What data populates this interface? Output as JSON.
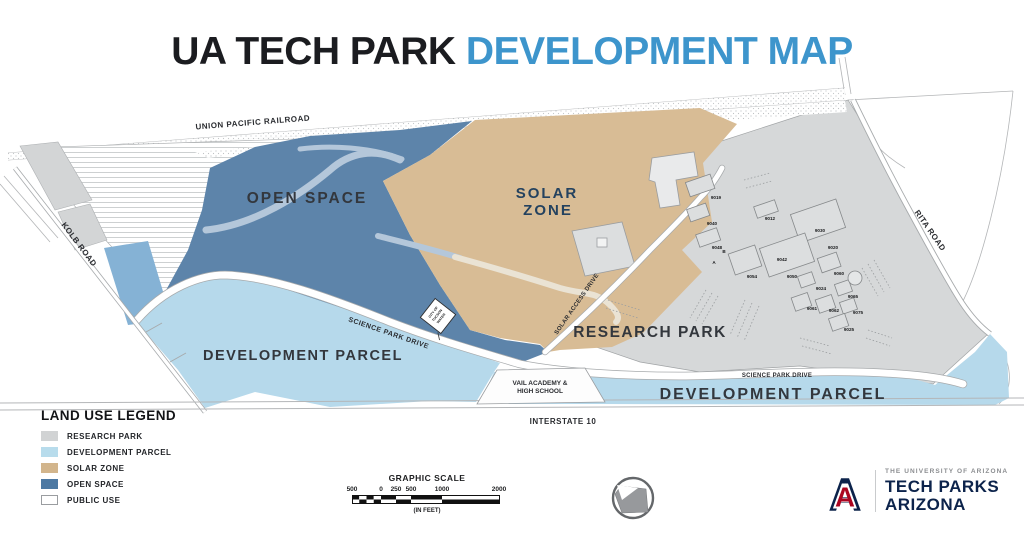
{
  "title": {
    "part1": "UA TECH PARK",
    "part2": "DEVELOPMENT MAP"
  },
  "map": {
    "region_labels": {
      "open_space": "OPEN SPACE",
      "solar_zone_line1": "SOLAR",
      "solar_zone_line2": "ZONE",
      "research_park": "RESEARCH PARK",
      "development_parcel_west": "DEVELOPMENT PARCEL",
      "development_parcel_east": "DEVELOPMENT PARCEL"
    },
    "road_labels": {
      "union_pacific": "UNION PACIFIC RAILROAD",
      "kolb": "KOLB ROAD",
      "science_park_drive_west": "SCIENCE PARK DRIVE",
      "science_park_drive_south": "SCIENCE PARK DRIVE",
      "solar_access": "SOLAR ACCESS DRIVE",
      "rita": "RITA ROAD",
      "interstate": "INTERSTATE 10"
    },
    "poi": {
      "vail_line1": "VAIL ACADEMY &",
      "vail_line2": "HIGH SCHOOL",
      "water_line1": "CITY OF",
      "water_line2": "TUCSON",
      "water_line3": "WATER"
    },
    "buildings": [
      {
        "label": "9019",
        "x": 716,
        "y": 199
      },
      {
        "label": "9040",
        "x": 712,
        "y": 225
      },
      {
        "label": "9048",
        "x": 717,
        "y": 249
      },
      {
        "label": "9012",
        "x": 770,
        "y": 220
      },
      {
        "label": "9030",
        "x": 820,
        "y": 232
      },
      {
        "label": "9020",
        "x": 833,
        "y": 249
      },
      {
        "label": "9042",
        "x": 782,
        "y": 261
      },
      {
        "label": "9050",
        "x": 792,
        "y": 278
      },
      {
        "label": "9054",
        "x": 752,
        "y": 278
      },
      {
        "label": "9060",
        "x": 839,
        "y": 275
      },
      {
        "label": "9024",
        "x": 821,
        "y": 290
      },
      {
        "label": "9065",
        "x": 853,
        "y": 298
      },
      {
        "label": "9061",
        "x": 812,
        "y": 310
      },
      {
        "label": "9062",
        "x": 834,
        "y": 312
      },
      {
        "label": "9075",
        "x": 858,
        "y": 314
      },
      {
        "label": "9025",
        "x": 849,
        "y": 331
      },
      {
        "label": "B",
        "x": 724,
        "y": 253
      },
      {
        "label": "A",
        "x": 714,
        "y": 264
      }
    ]
  },
  "legend": {
    "title": "LAND USE LEGEND",
    "items": [
      {
        "label": "RESEARCH PARK",
        "color": "#d1d3d4",
        "border": "#d1d3d4"
      },
      {
        "label": "DEVELOPMENT PARCEL",
        "color": "#b8dcec",
        "border": "#b8dcec"
      },
      {
        "label": "SOLAR ZONE",
        "color": "#d2b58c",
        "border": "#d2b58c"
      },
      {
        "label": "OPEN SPACE",
        "color": "#4d79a3",
        "border": "#4d79a3"
      },
      {
        "label": "PUBLIC USE",
        "color": "#ffffff",
        "border": "#9a9da0"
      }
    ]
  },
  "scale": {
    "title": "GRAPHIC SCALE",
    "ticks": [
      "500",
      "0",
      "250",
      "500",
      "1000",
      "2000"
    ],
    "units": "(IN FEET)"
  },
  "logo": {
    "institution": "THE UNIVERSITY OF ARIZONA",
    "name_line1": "TECH PARKS",
    "name_line2": "ARIZONA",
    "letter": "A"
  },
  "colors": {
    "open_space": "#5d84aa",
    "development_parcel": "#b6d9eb",
    "development_parcel_medium": "#85b2d5",
    "solar_zone": "#d8bc95",
    "research_park": "#d6d8d9",
    "accent_blue": "#3d95cc",
    "navy": "#0c234b",
    "red": "#ab0520"
  }
}
